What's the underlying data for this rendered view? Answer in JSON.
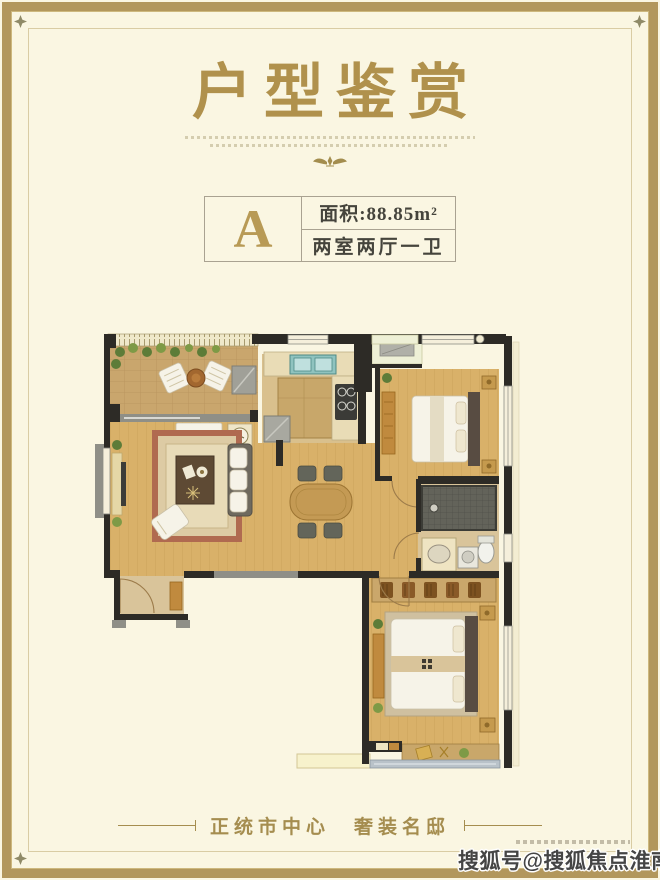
{
  "palette": {
    "bg": "#faf6e2",
    "frame": "#b2975c",
    "hairline": "#d9cca4",
    "titleGold": "#b0914c",
    "unitGold": "#b89a55",
    "tagGold": "#a58d4f",
    "textDark": "#45443c",
    "cardBorder": "#a9a291",
    "wall": "#2d2b26",
    "wallGray": "#8f8f87",
    "wood": "#d9b169",
    "kitchenFloor": "#d9c08d",
    "tanFloor": "#d9c49a",
    "paleGreen": "#eef0d6",
    "goldFurn": "#c59a4e",
    "plant": "#5d7c38",
    "rugBorder": "#b06a50",
    "teal": "#8fc3bf"
  },
  "title": {
    "text": "户型鉴赏"
  },
  "icons": {
    "corner_ornament": "four-point-star",
    "divider_ornament": "winged-emblem"
  },
  "unit_card": {
    "letter": "A",
    "area": "面积:88.85m²",
    "layout": "两室两厅一卫"
  },
  "floor_plan": {
    "type": "residential-unit-plan",
    "rooms": [
      "terrace",
      "living-room",
      "dining-area",
      "kitchen",
      "laundry-balcony",
      "bedroom",
      "bathroom",
      "master-bedroom",
      "south-balcony",
      "entry-hall"
    ]
  },
  "tagline": {
    "text": "正统市中心　奢装名邸"
  },
  "watermark": {
    "text": "搜狐号@搜狐焦点淮南站"
  }
}
